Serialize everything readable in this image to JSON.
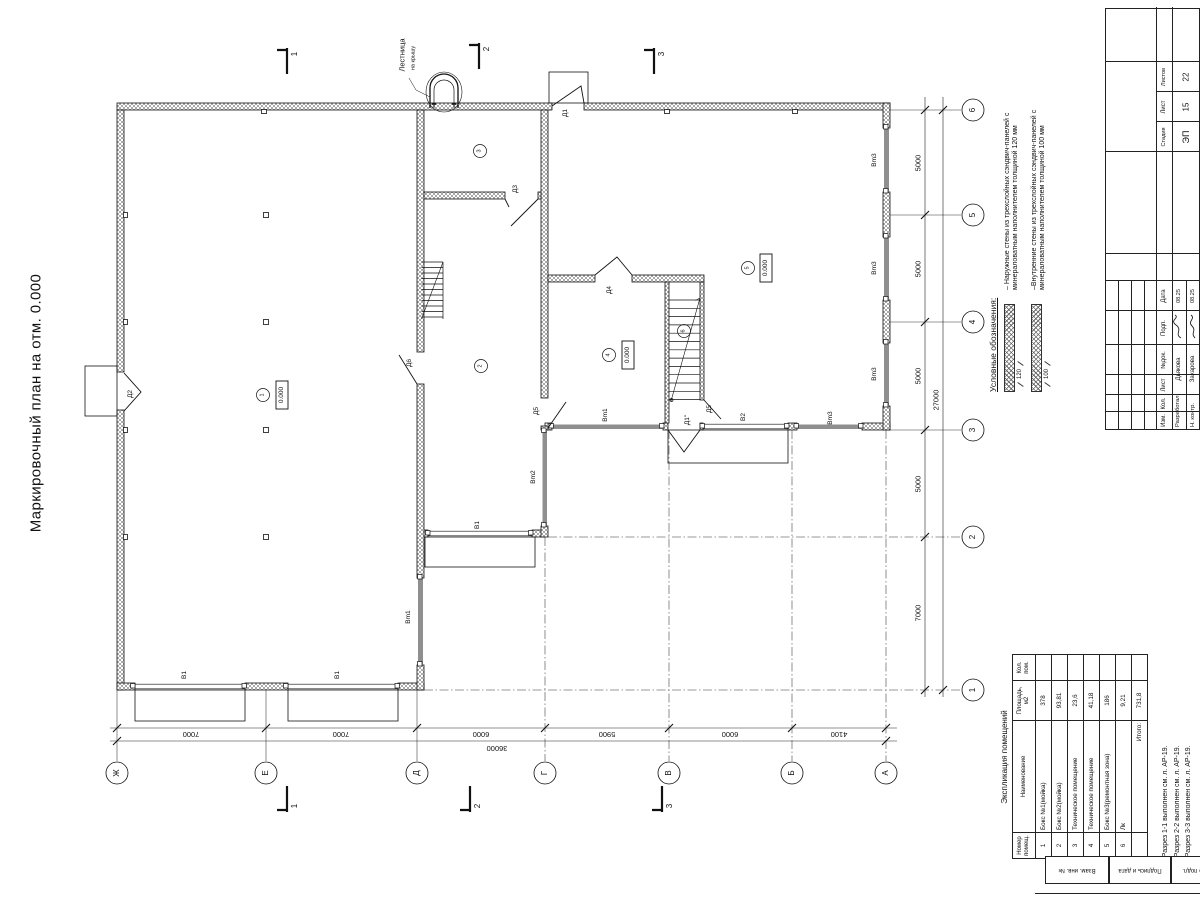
{
  "title": "Маркировочный план на отм. 0.000",
  "plan": {
    "axes_bottom": [
      "Ж",
      "Е",
      "Д",
      "Г",
      "В",
      "Б",
      "А"
    ],
    "axes_right": [
      "1",
      "2",
      "3",
      "4",
      "5",
      "6"
    ],
    "dims_bottom": [
      "7000",
      "7000",
      "6000",
      "5900",
      "6000",
      "4100"
    ],
    "dim_bottom_total": "36000",
    "dims_right": [
      "7000",
      "5000",
      "5000",
      "5000",
      "5000"
    ],
    "dim_right_total": "27000",
    "sections": [
      "1",
      "2",
      "3"
    ],
    "rooms": [
      "1",
      "2",
      "3",
      "4",
      "5",
      "6"
    ],
    "elevation": "0.000",
    "doors": {
      "d1": "Д1",
      "d1p": "Д1\"",
      "d2": "Д2",
      "d3": "Д3",
      "d4": "Д4",
      "d5": "Д5",
      "d6": "Д6"
    },
    "gates": {
      "v1": "В1",
      "v2": "В2",
      "vm1": "Вm1",
      "vm2": "Вm2",
      "vm3": "Вm3"
    },
    "ladder_label_1": "Лестница",
    "ladder_label_2": "на крышу"
  },
  "legend": {
    "heading": "Условные обозначения:",
    "items": [
      {
        "dim": "120",
        "text": "– Наружные стены из трехслойных сэндвич-панелей с минераловатным наполнителем толщиной 120 мм"
      },
      {
        "dim": "100",
        "text": "–Внутренние стены из трехслойных сэндвич-панелей с минераловатным наполнителем толщиной 100 мм"
      }
    ]
  },
  "explication": {
    "caption": "Экспликация помещений",
    "headers": [
      "Номер помещ.",
      "Наименование",
      "Площадь, м2",
      "Кол. пом."
    ],
    "rows": [
      [
        "1",
        "Бокс №1(мойка)",
        "378",
        ""
      ],
      [
        "2",
        "Бокс №2(мойка)",
        "93,81",
        ""
      ],
      [
        "3",
        "Техническое помещение",
        "23,6",
        ""
      ],
      [
        "4",
        "Техническое помещение",
        "41,18",
        ""
      ],
      [
        "5",
        "Бокс №3(ремонтная зона)",
        "186",
        ""
      ],
      [
        "6",
        "Лк",
        "9,21",
        ""
      ]
    ],
    "total_label": "Итого:",
    "total_value": "731,8"
  },
  "notes": [
    "1. Разрез 1-1 выполнен см. л. АР-19.",
    "2. Разрез 2-2 выполнен см. л. АР-19.",
    "3. Разрез 3-3 выполнен см. л. АР-19."
  ],
  "titleblock": {
    "cols": [
      "Изм.",
      "Кол.",
      "Лист",
      "№док.",
      "Подп.",
      "Дата"
    ],
    "stage_label": "Стадия",
    "sheet_label": "Лист",
    "sheets_label": "Листов",
    "stage": "ЭП",
    "sheet": "15",
    "sheets": "22",
    "row1_role": "Разработал",
    "row1_name": "Дьякова",
    "row1_date": "08.25",
    "row2_role": "Н. контр.",
    "row2_name": "Захарова",
    "row2_date": "08.25"
  },
  "side_strip": [
    "Взам. инв. №",
    "Подпись и дата",
    "Инв. № подл."
  ],
  "colors": {
    "ink": "#111111",
    "gate_gray": "#8f8f8f"
  }
}
